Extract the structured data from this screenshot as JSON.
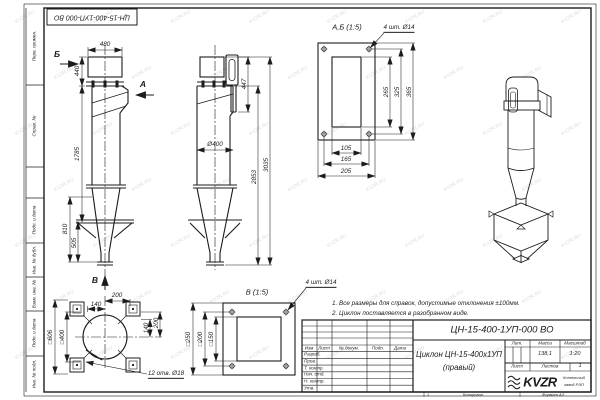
{
  "sheet": {
    "stamp": "ЦН-15-400-1УП-000 ВО",
    "watermark": "KVZR.RU",
    "colors": {
      "line": "#1c1c1c",
      "watermark": "#c0c3c5"
    },
    "margin_labels": {
      "perv": "Перв. примен.",
      "sprav": "Справ. №",
      "podp1": "Подп. и дата",
      "inv_dubl": "Инв. № дубл.",
      "vzam": "Взам. инв. №",
      "podp2": "Подп. и дата",
      "inv_podl": "Инв. № подл."
    },
    "footer": {
      "zone": "1",
      "copied": "Копировал",
      "format": "Формат А3"
    }
  },
  "notes": {
    "line1": "1. Все размеры для справок, допустимые отклонения ±100мм.",
    "line2": "2. Циклон поставляется в разобранном виде."
  },
  "front_view": {
    "label_b": "Б",
    "label_a": "А",
    "label_v": "В",
    "dim_width": "480",
    "dim_inlet": "440",
    "dim_body": "1785",
    "dim_cone_h": "810",
    "dim_cone_l": "505"
  },
  "side_view": {
    "dim_top": "447",
    "dim_dia": "Ø400",
    "dim_h1": "2853",
    "dim_h2": "3035"
  },
  "detail_ab": {
    "title": "А,Б (1:5)",
    "callout": "4 шт. Ø14",
    "dim_v1": "265",
    "dim_v2": "325",
    "dim_v3": "365",
    "dim_h1": "105",
    "dim_h2": "165",
    "dim_h3": "205"
  },
  "bottom_view": {
    "callout": "12 отв. Ø18",
    "dim_sq_outer": "□606",
    "dim_sq_inner": "□400",
    "dim_t1": "200",
    "dim_t2": "140",
    "dim_r1": "140",
    "dim_r2": "200"
  },
  "detail_v": {
    "title": "В (1:5)",
    "callout": "4 шт. Ø14",
    "dim_outer": "□250",
    "dim_mid": "□200",
    "dim_inner": "□150"
  },
  "title_block": {
    "designation": "ЦН-15-400-1УП-000 ВО",
    "name_line1": "Циклон ЦН-15-400х1УП",
    "name_line2": "(правый)",
    "hdr_izm": "Изм",
    "hdr_list": "Лист",
    "hdr_doc": "№ докум.",
    "hdr_podp": "Подп.",
    "hdr_data": "Дата",
    "row1": "Разраб.",
    "row2": "Пров.",
    "row3": "Т. контр.",
    "row4": "Нач. отд.",
    "row5": "Н. контр.",
    "row6": "Утв.",
    "lit": "Лит.",
    "mass": "Масса",
    "scale": "Масштаб",
    "mass_value": "138,1",
    "scale_value": "1:20",
    "sheet": "Лист",
    "sheets": "Листов",
    "sheets_value": "1",
    "logo": "KVZR",
    "logo_sub1": "Котельный",
    "logo_sub2": "завод РЭП"
  }
}
